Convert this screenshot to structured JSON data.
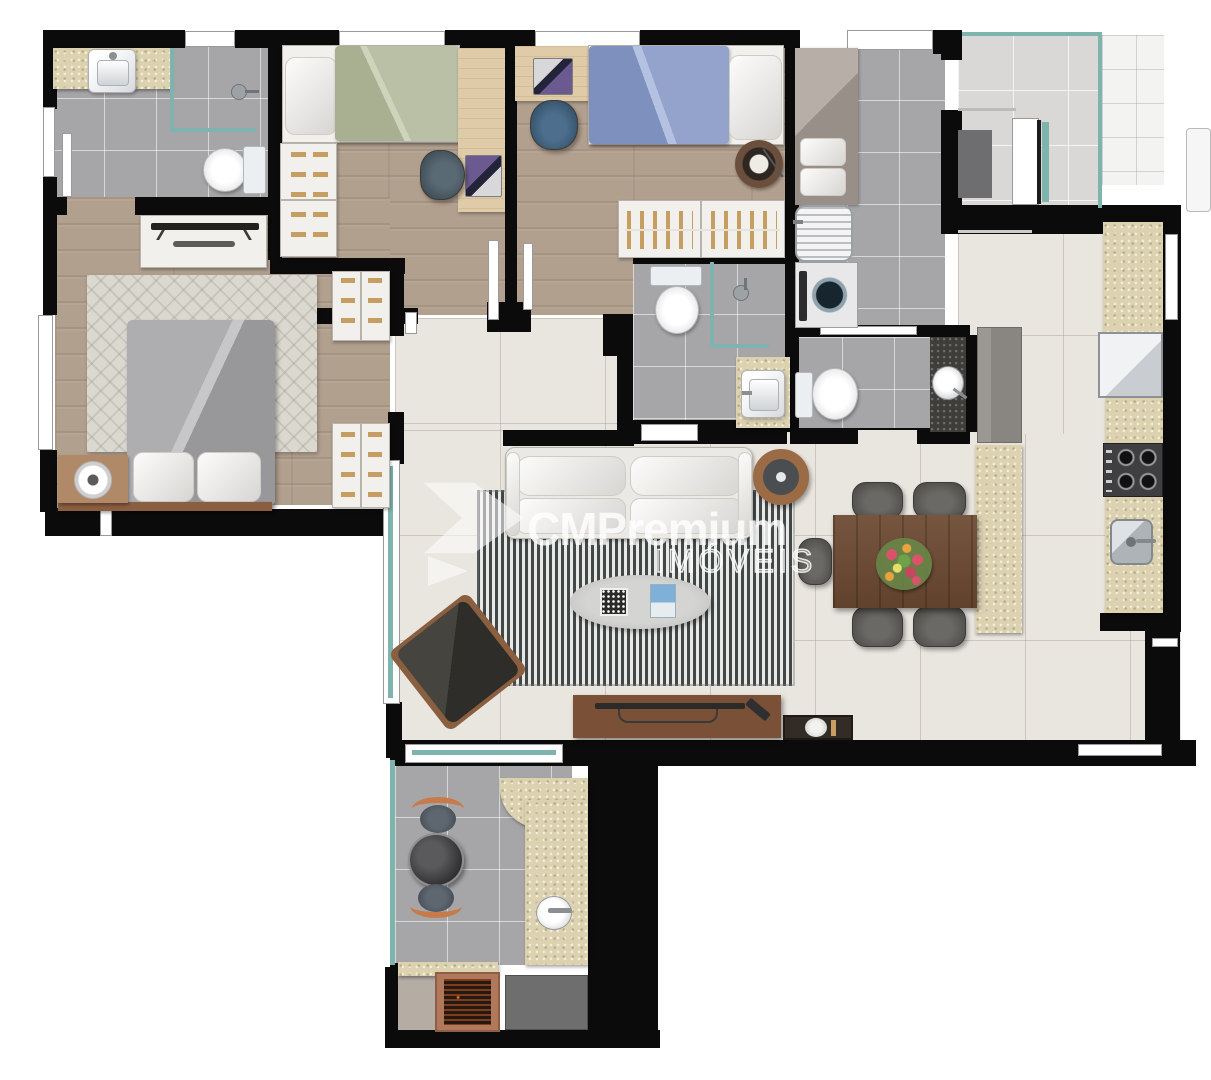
{
  "watermark": {
    "brand": "CMPremium",
    "subtitle": "IMÓVEIS"
  },
  "palette": {
    "wall": "#0b0b0b",
    "wood_floor": "#b2a08f",
    "tile_gray": "#a6a6a8",
    "tile_light": "#e9e5df",
    "tile_external": "#d9d8d6",
    "granite_beige": "#dcd2b0",
    "granite_dark": "#3e3d39",
    "glass": "#7fb4ae",
    "rug_stripe_dark": "#42474a",
    "bed_green": "#b9bfa8",
    "bed_blue": "#8b9cc7",
    "bed_gray": "#a5a5a7",
    "wood_dark": "#6e4b33",
    "handle_tan": "#c79e62",
    "grill_frame": "#b0795b"
  },
  "rooms": [
    {
      "id": "suite-bathroom",
      "items": [
        "vanity-sink",
        "shower-box",
        "toilet",
        "door-leaf"
      ]
    },
    {
      "id": "master-bedroom",
      "items": [
        "tv-console",
        "patterned-rug",
        "double-bed",
        "pillows",
        "nightstand-speaker",
        "wardrobe-upper",
        "wardrobe-lower"
      ]
    },
    {
      "id": "bedroom-1",
      "items": [
        "single-bed-green",
        "drawer-dresser",
        "desk",
        "laptop",
        "desk-chair"
      ]
    },
    {
      "id": "bedroom-2",
      "items": [
        "desk",
        "laptop",
        "desk-chair",
        "single-bed-blue",
        "round-rug",
        "floor-lamp",
        "hanger-wardrobe"
      ]
    },
    {
      "id": "hallway",
      "items": []
    },
    {
      "id": "bathroom-2",
      "items": [
        "toilet",
        "shower-box",
        "square-sink"
      ]
    },
    {
      "id": "laundry",
      "items": [
        "counter-towels",
        "laundry-tank-sink",
        "washing-machine"
      ]
    },
    {
      "id": "bathroom-3",
      "items": [
        "toilet",
        "dark-counter-vessel-sink"
      ]
    },
    {
      "id": "entry-hall",
      "items": [
        "doormat",
        "entry-door",
        "glass-rail",
        "cabinet"
      ]
    },
    {
      "id": "kitchen",
      "items": [
        "counter-granite",
        "refrigerator",
        "cooktop",
        "kitchen-sink",
        "island-counter",
        "island-cabinet"
      ]
    },
    {
      "id": "living-dining",
      "items": [
        "sofa",
        "round-side-table",
        "striped-rug",
        "oval-coffee-table",
        "books",
        "lounge-armchair",
        "tv-console",
        "plant-console",
        "dining-table",
        "flower-centerpiece",
        "dining-chairs"
      ]
    },
    {
      "id": "terrace",
      "items": [
        "glass-wall",
        "bistro-table",
        "bistro-chairs",
        "stone-counter",
        "round-sink",
        "barbecue-grill",
        "service-counter"
      ]
    }
  ]
}
